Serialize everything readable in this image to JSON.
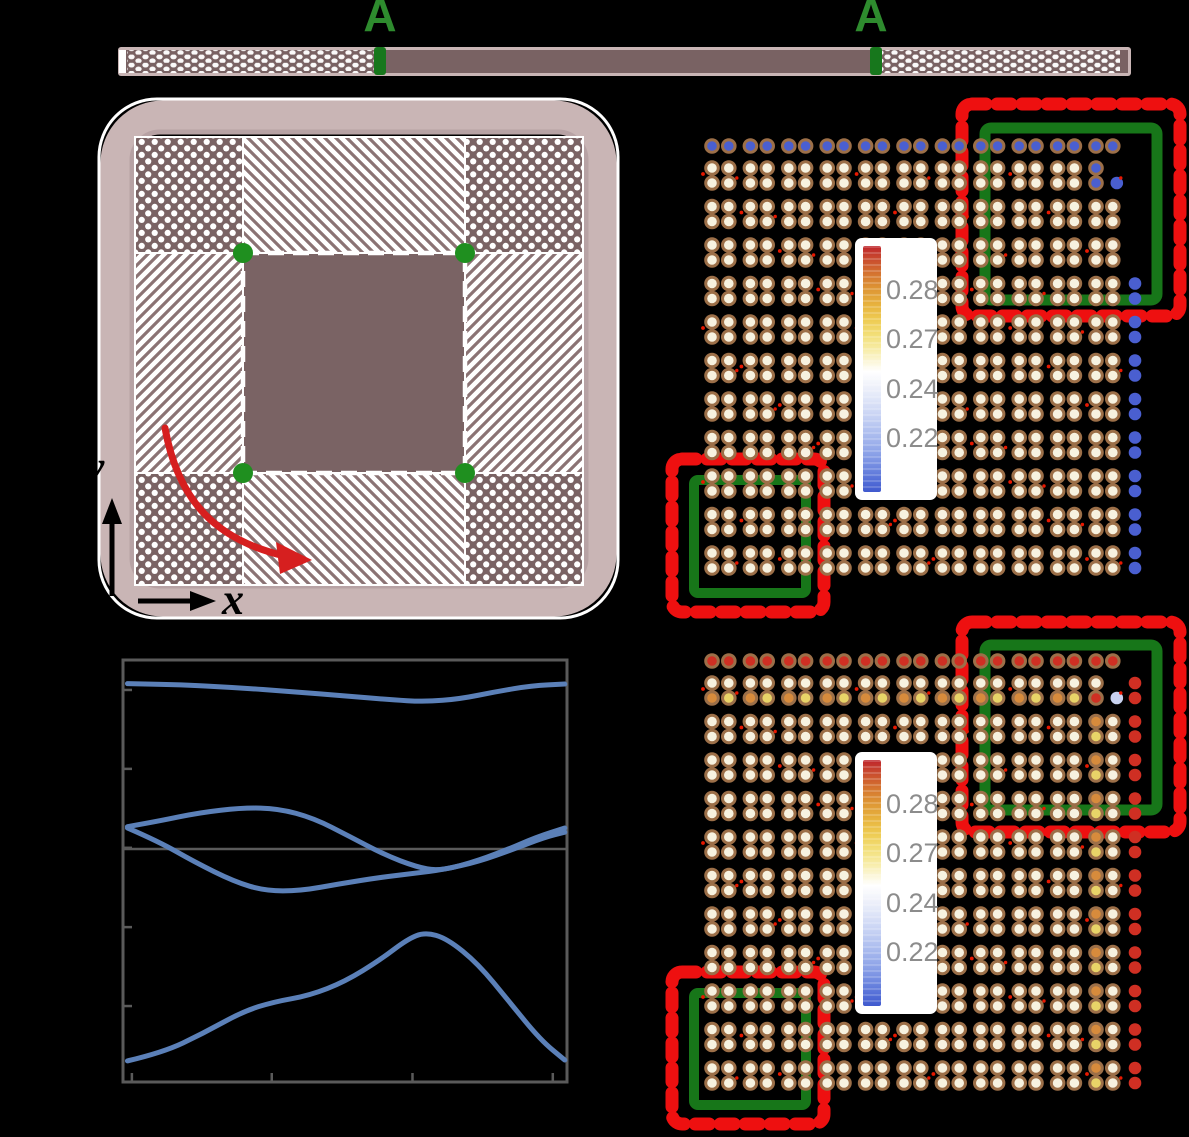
{
  "figure_type": "scientific-figure",
  "labels": {
    "section_left": "A",
    "section_right": "A",
    "beam_axis_x": "x",
    "cell_axis_x": "x",
    "cell_axis_y": "y"
  },
  "colorbar": {
    "ticks": [
      "0.28",
      "0.27",
      "0.24",
      "0.22"
    ]
  },
  "colors": {
    "background": "#000000",
    "beam_fill": "#796263",
    "beam_border": "#c9b5b5",
    "green_accent": "#2e8b2e",
    "green_marker": "#17771c",
    "green_dot": "#1f8f1f",
    "box_green": "#177619",
    "box_red": "#ee1010",
    "red_arrow": "#d61f1f",
    "mauve": "#7a6364",
    "hatch_stroke": "#8b7374",
    "curve_blue": "#5b80b8",
    "axis_gray": "#5a5a5a",
    "dot_cream": "#f7f2e0",
    "dot_ring": "#9c6f48",
    "dot_blue": "#4a5fd0",
    "dot_red": "#cf2f23",
    "dot_orange": "#d78b3c",
    "dot_yellow": "#e8d468",
    "dot_lavender": "#c9d2f0",
    "tick_text": "#8c8c8c",
    "speck_red": "#e81800"
  },
  "chart_data": {
    "type": "line",
    "title": "",
    "xlabel": "",
    "ylabel": "",
    "note": "band-structure dispersion; axis tick labels are not visible in the image (black on black); coordinates given as fractions of the plot frame (x: 0-1 left-right, y: 0-1 top-bottom)",
    "x_ticks_frac": [
      0.02,
      0.335,
      0.652,
      0.968
    ],
    "y_ticks_frac": [
      0.071,
      0.258,
      0.445,
      0.633,
      0.82
    ],
    "reference_line_y_frac": 0.448,
    "grid": false,
    "legend": null,
    "series": [
      {
        "name": "band-1",
        "points": [
          [
            0.01,
            0.056
          ],
          [
            0.12,
            0.058
          ],
          [
            0.25,
            0.065
          ],
          [
            0.38,
            0.075
          ],
          [
            0.5,
            0.085
          ],
          [
            0.6,
            0.094
          ],
          [
            0.68,
            0.099
          ],
          [
            0.76,
            0.092
          ],
          [
            0.84,
            0.075
          ],
          [
            0.92,
            0.061
          ],
          [
            0.995,
            0.057
          ]
        ]
      },
      {
        "name": "band-2",
        "points": [
          [
            0.01,
            0.395
          ],
          [
            0.08,
            0.382
          ],
          [
            0.17,
            0.362
          ],
          [
            0.27,
            0.35
          ],
          [
            0.35,
            0.352
          ],
          [
            0.43,
            0.375
          ],
          [
            0.51,
            0.418
          ],
          [
            0.59,
            0.462
          ],
          [
            0.66,
            0.49
          ],
          [
            0.71,
            0.5
          ],
          [
            0.78,
            0.482
          ],
          [
            0.86,
            0.452
          ],
          [
            0.93,
            0.42
          ],
          [
            0.995,
            0.398
          ]
        ]
      },
      {
        "name": "band-3",
        "points": [
          [
            0.01,
            0.398
          ],
          [
            0.08,
            0.43
          ],
          [
            0.16,
            0.478
          ],
          [
            0.25,
            0.525
          ],
          [
            0.32,
            0.547
          ],
          [
            0.4,
            0.547
          ],
          [
            0.49,
            0.53
          ],
          [
            0.58,
            0.515
          ],
          [
            0.66,
            0.505
          ],
          [
            0.72,
            0.497
          ],
          [
            0.8,
            0.478
          ],
          [
            0.88,
            0.448
          ],
          [
            0.95,
            0.42
          ],
          [
            0.995,
            0.408
          ]
        ]
      },
      {
        "name": "band-4",
        "points": [
          [
            0.01,
            0.95
          ],
          [
            0.09,
            0.93
          ],
          [
            0.18,
            0.885
          ],
          [
            0.27,
            0.833
          ],
          [
            0.34,
            0.81
          ],
          [
            0.42,
            0.795
          ],
          [
            0.5,
            0.762
          ],
          [
            0.58,
            0.71
          ],
          [
            0.64,
            0.662
          ],
          [
            0.68,
            0.645
          ],
          [
            0.73,
            0.66
          ],
          [
            0.8,
            0.72
          ],
          [
            0.87,
            0.81
          ],
          [
            0.94,
            0.9
          ],
          [
            0.995,
            0.948
          ]
        ]
      }
    ]
  },
  "lattice_panels": {
    "upper": {
      "cols": 11,
      "rows": 11,
      "default_fill": "dot_cream",
      "top_row_fill": "dot_blue",
      "right_col_fill": "dot_blue",
      "right_col_rows": [
        3,
        10
      ],
      "defect": {
        "col": 10,
        "row": 0,
        "tl": "dot_blue",
        "tr": null,
        "bl": "dot_blue",
        "br": "dot_blue"
      },
      "row0_bottom": null,
      "col_accent": null
    },
    "lower": {
      "cols": 11,
      "rows": 11,
      "default_fill": "dot_cream",
      "top_row_fill": "dot_red",
      "right_col_fill": "dot_red",
      "right_col_rows": [
        0,
        10
      ],
      "defect": {
        "col": 10,
        "row": 0,
        "tl": "dot_cream",
        "tr": null,
        "bl": "dot_red",
        "br": "dot_lavender"
      },
      "row0_bottom": [
        "dot_orange",
        "dot_yellow"
      ],
      "col_accent": {
        "col": 10,
        "rows": [
          1,
          10
        ],
        "tl": "dot_orange",
        "bl": "dot_yellow"
      }
    }
  }
}
